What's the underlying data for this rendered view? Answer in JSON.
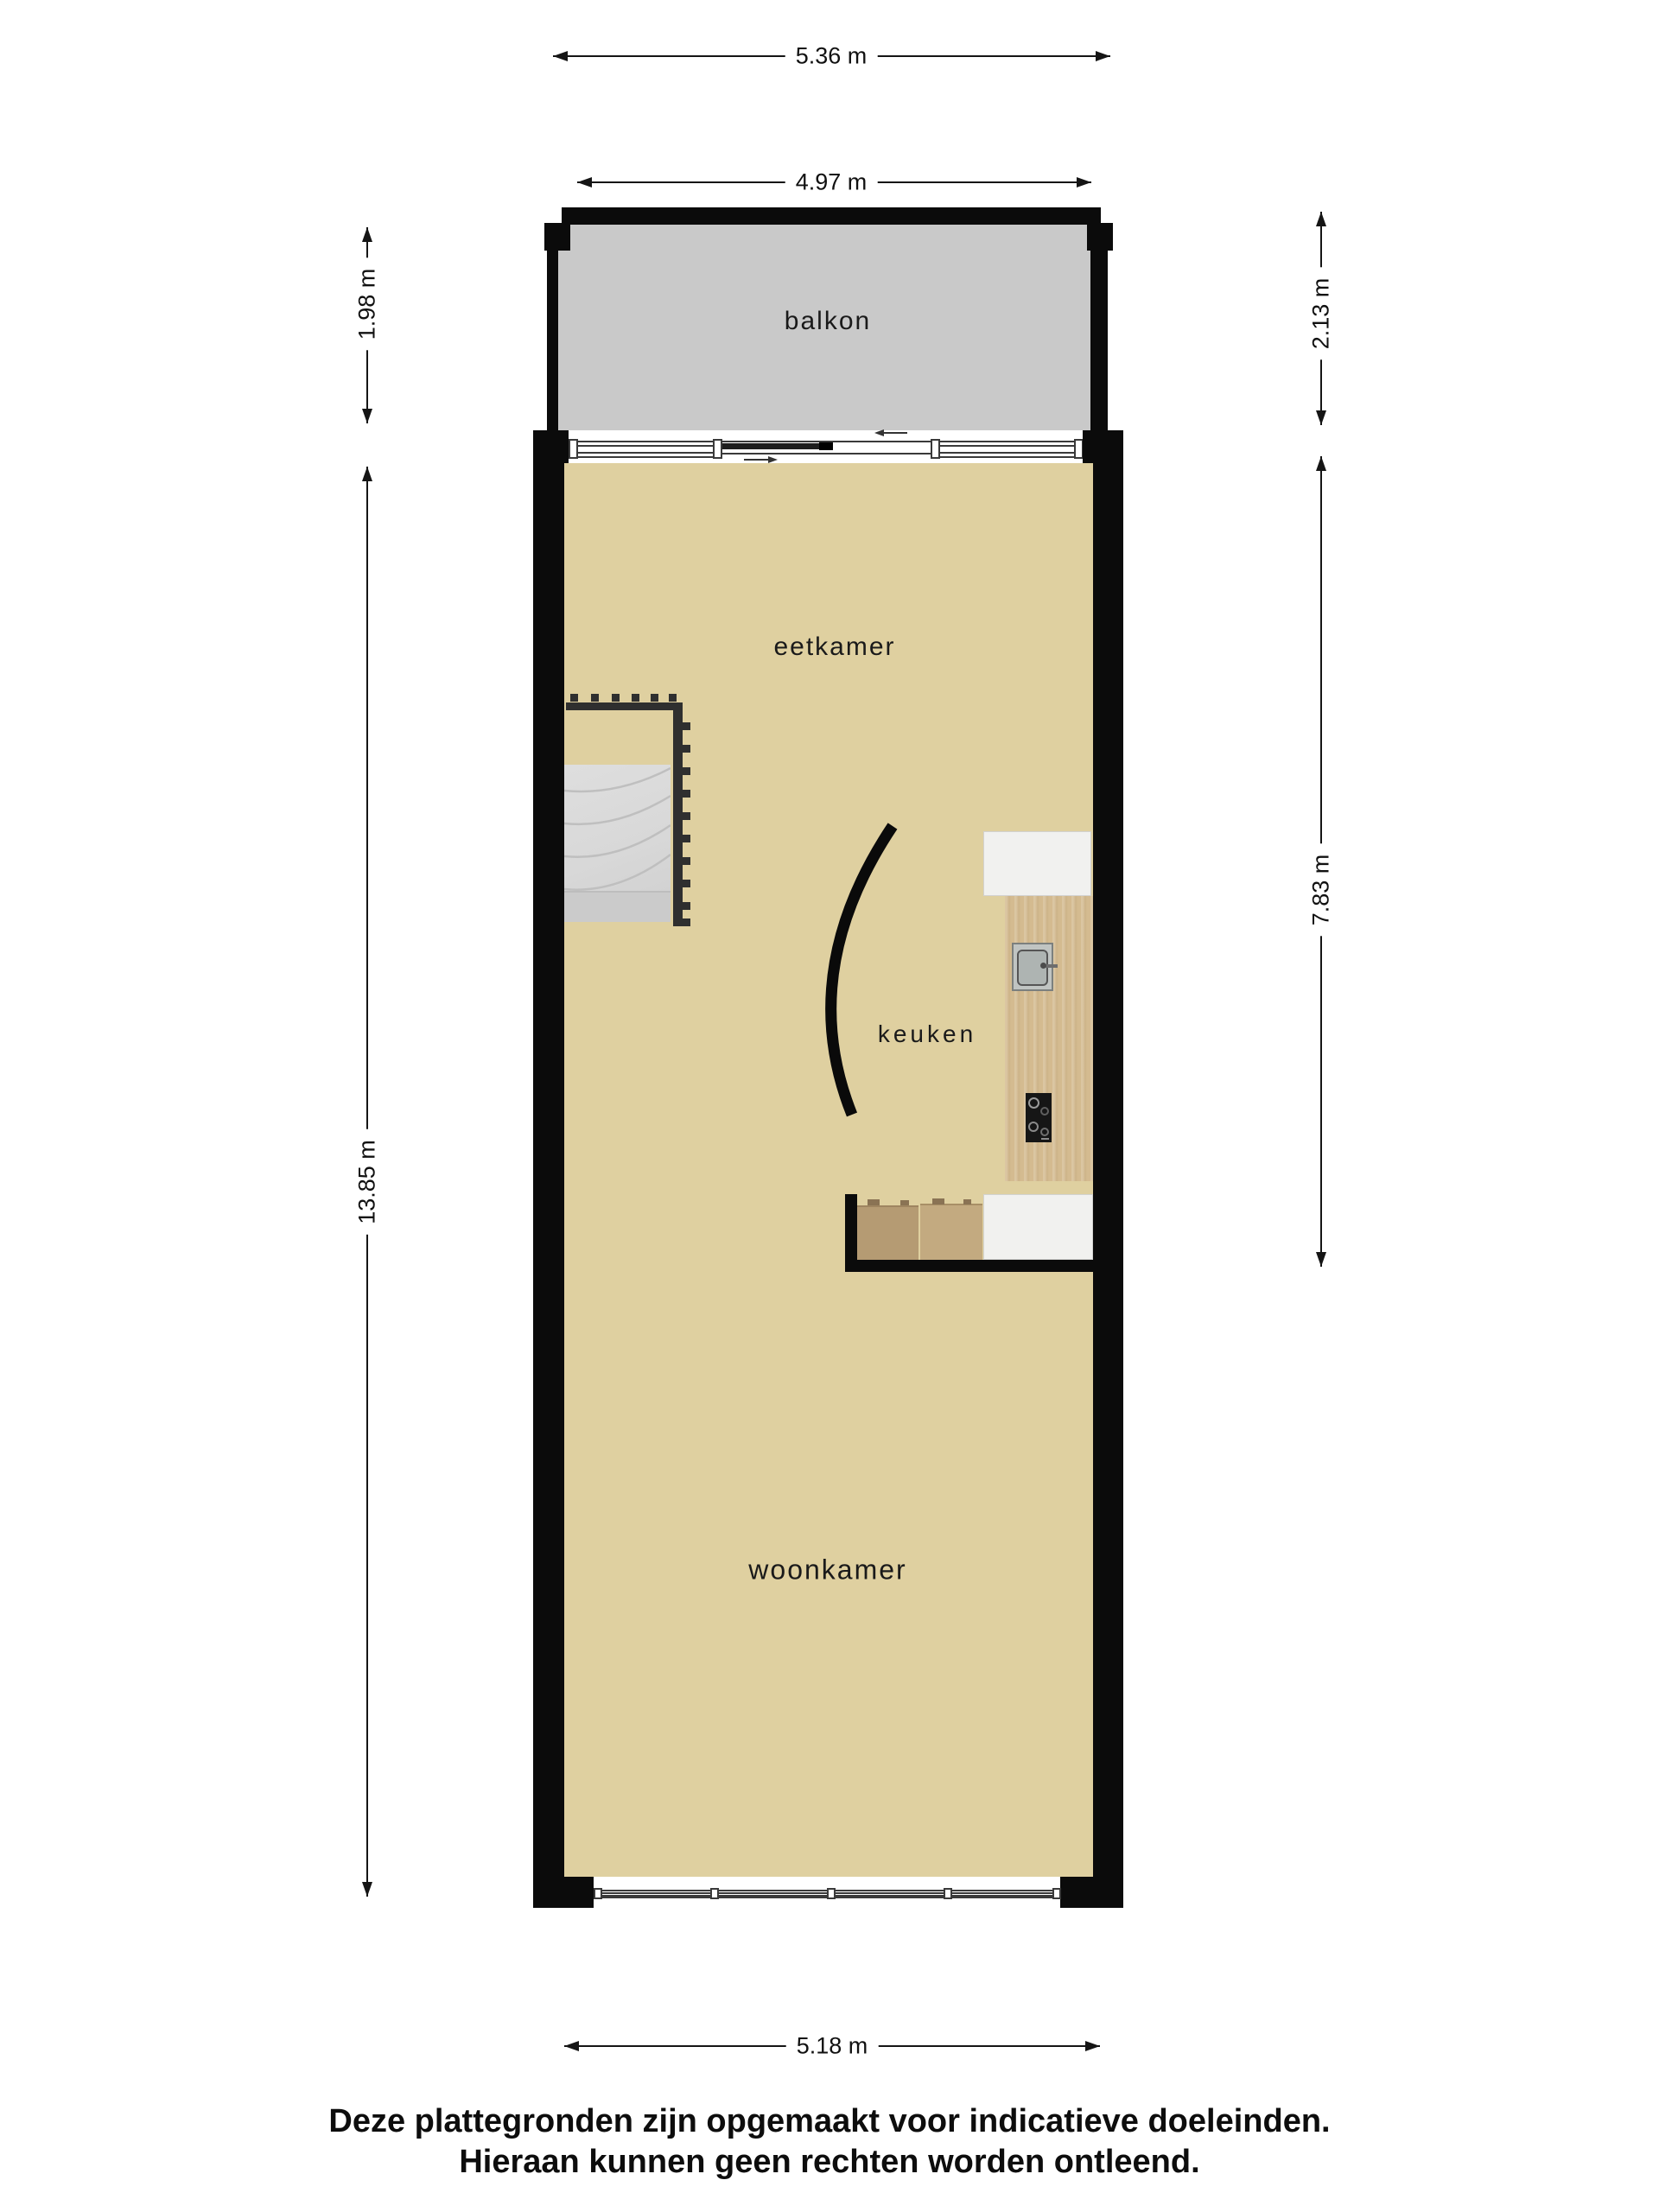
{
  "title": "floor-plan",
  "rooms": {
    "balkon": {
      "label": "balkon"
    },
    "eetkamer": {
      "label": "eetkamer"
    },
    "keuken": {
      "label": "keuken"
    },
    "woonkamer": {
      "label": "woonkamer"
    }
  },
  "dimensions": {
    "balcony_outer_width": "5.36 m",
    "balcony_inner_width": "4.97 m",
    "balcony_depth_left": "1.98 m",
    "balcony_depth_right": "2.13 m",
    "kitchen_zone_height": "7.83 m",
    "apartment_height": "13.85 m",
    "apartment_width": "5.18 m"
  },
  "footer": {
    "line1": "Deze plattegronden zijn opgemaakt voor indicatieve doeleinden.",
    "line2": "Hieraan kunnen geen rechten worden ontleend."
  },
  "colors": {
    "wall": "#0b0b0b",
    "floor": "#dfd0a0",
    "balcony": "#c9c9c9",
    "wood": "#d4bb90",
    "cab1": "#b59b73",
    "cab2": "#c3aa80",
    "counter": "#f1f1ef",
    "stairs": "#d8d8d8",
    "landing": "#cbcbcb",
    "railing": "#2f2f2f",
    "ink": "#151515"
  }
}
